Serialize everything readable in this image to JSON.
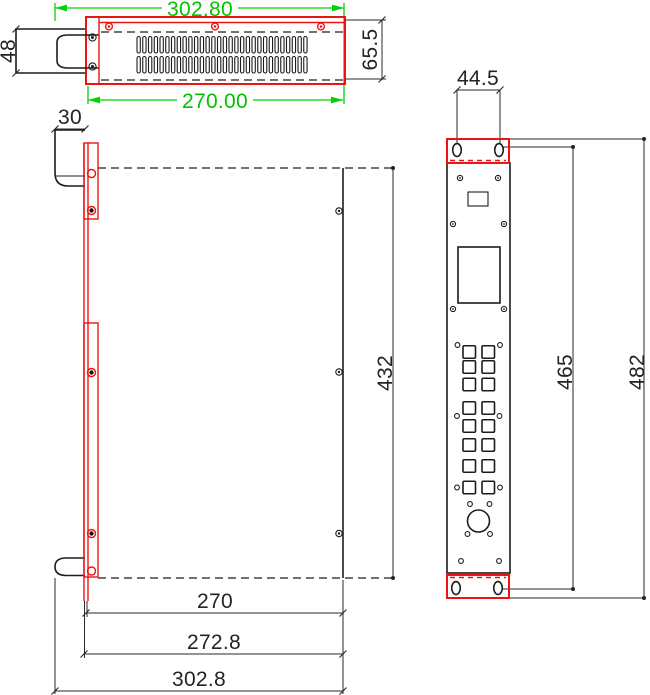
{
  "views": {
    "top_view": {
      "dims": {
        "overall_width": "302.80",
        "vent_width": "270.00",
        "handle_height": "48",
        "panel_depth": "65.5"
      }
    },
    "side_view": {
      "dims": {
        "handle_depth": "30",
        "body_length": "432",
        "body_width": "270",
        "body_with_panel_width": "272.8",
        "overall_width": "302.8"
      }
    },
    "front_view": {
      "dims": {
        "ear_hole_spacing": "44.5",
        "mount_hole_span": "465",
        "overall_height": "482"
      }
    }
  },
  "colors": {
    "dimension_green": "#00d400",
    "highlight_red": "#ee1313",
    "line_black": "#1c1c1c",
    "background": "#ffffff"
  }
}
